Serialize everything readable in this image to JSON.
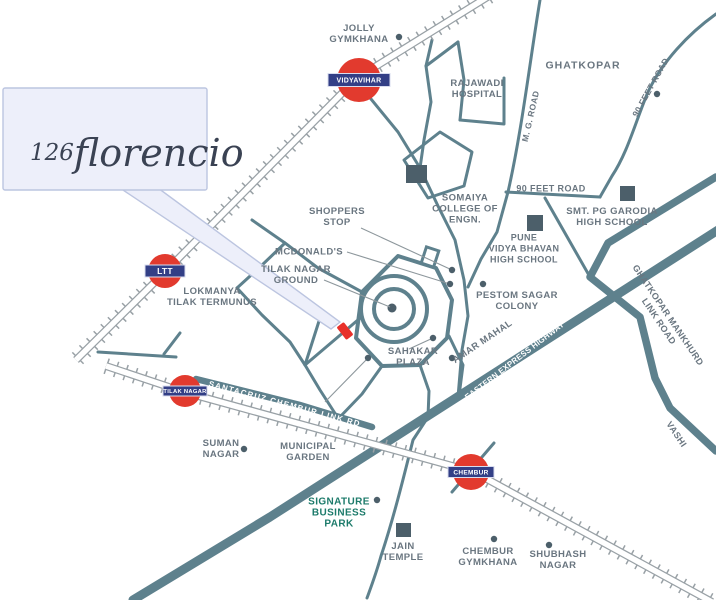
{
  "callout": {
    "prefix": "126",
    "name": "florencio"
  },
  "map": {
    "colors": {
      "road": "#5e818d",
      "rail": "#99a1a6",
      "label": "#6a7680",
      "green_label": "#1d7b6b",
      "white_label": "#ffffff",
      "badge_red": "#e23a2e",
      "badge_navy": "#333f86",
      "marker_red": "#e8302a",
      "building": "#4c5f6a",
      "callout_bg": "#edeffa"
    },
    "stations": [
      {
        "id": "vidyavihar",
        "label": "VIDYAVIHAR",
        "x": 359,
        "y": 80,
        "r": 22,
        "bw": 62,
        "bh": 13,
        "fs": 7
      },
      {
        "id": "ltt",
        "label": "LTT",
        "x": 165,
        "y": 271,
        "r": 17,
        "bw": 40,
        "bh": 12,
        "fs": 8.5
      },
      {
        "id": "tilak-nagar",
        "label": "TILAK NAGAR",
        "x": 185,
        "y": 391,
        "r": 16,
        "bw": 44,
        "bh": 10,
        "fs": 5.8
      },
      {
        "id": "chembur",
        "label": "CHEMBUR",
        "x": 471,
        "y": 472,
        "r": 18,
        "bw": 46,
        "bh": 11,
        "fs": 6.5
      }
    ],
    "labels": [
      {
        "id": "jolly-gymkhana",
        "x": 359,
        "y": 33,
        "lines": [
          "JOLLY",
          "GYMKHANA"
        ]
      },
      {
        "id": "ghatkopar",
        "x": 583,
        "y": 65,
        "size": 10.5,
        "ls": 1,
        "lines": [
          "GHATKOPAR"
        ]
      },
      {
        "id": "rajawadi-hospital",
        "x": 477,
        "y": 88,
        "lines": [
          "RAJAWADI",
          "HOSPITAL"
        ]
      },
      {
        "id": "somaiya-college",
        "x": 465,
        "y": 208,
        "lines": [
          "SOMAIYA",
          "COLLEGE OF",
          "ENGN."
        ]
      },
      {
        "id": "ninety-feet-road-h",
        "x": 551,
        "y": 188,
        "size": 9,
        "lines": [
          "90 FEET ROAD"
        ]
      },
      {
        "id": "garodia-school",
        "x": 612,
        "y": 216,
        "lines": [
          "SMT. PG GARODIA",
          "HIGH SCHOOL"
        ]
      },
      {
        "id": "pune-vidya-bhavan",
        "x": 524,
        "y": 248,
        "size": 9,
        "lines": [
          "PUNE",
          "VIDYA BHAVAN",
          "HIGH SCHOOL"
        ]
      },
      {
        "id": "shoppers-stop",
        "x": 337,
        "y": 216,
        "lines": [
          "SHOPPERS",
          "STOP"
        ]
      },
      {
        "id": "mcdonalds",
        "x": 309,
        "y": 251,
        "lines": [
          "MCDONALD'S"
        ]
      },
      {
        "id": "tilak-nagar-ground",
        "x": 296,
        "y": 274,
        "lines": [
          "TILAK NAGAR",
          "GROUND"
        ]
      },
      {
        "id": "lokmanya-terminus",
        "x": 212,
        "y": 296,
        "lines": [
          "LOKMANYA",
          "TILAK TERMUNUS"
        ]
      },
      {
        "id": "pestom-sagar",
        "x": 517,
        "y": 300,
        "lines": [
          "PESTOM SAGAR",
          "COLONY"
        ]
      },
      {
        "id": "sahakar-plaza",
        "x": 413,
        "y": 356,
        "lines": [
          "SAHAKAR",
          "PLAZA"
        ]
      },
      {
        "id": "suman-nagar",
        "x": 221,
        "y": 448,
        "lines": [
          "SUMAN",
          "NAGAR"
        ]
      },
      {
        "id": "municipal-garden",
        "x": 308,
        "y": 451,
        "lines": [
          "MUNICIPAL",
          "GARDEN"
        ]
      },
      {
        "id": "signature-park",
        "x": 339,
        "y": 512,
        "size": 10,
        "color": "#1d7b6b",
        "lines": [
          "SIGNATURE",
          "BUSINESS",
          "PARK"
        ]
      },
      {
        "id": "jain-temple",
        "x": 403,
        "y": 551,
        "lines": [
          "JAIN",
          "TEMPLE"
        ]
      },
      {
        "id": "chembur-gymkhana",
        "x": 488,
        "y": 556,
        "lines": [
          "CHEMBUR",
          "GYMKHANA"
        ]
      },
      {
        "id": "shubhash-nagar",
        "x": 558,
        "y": 559,
        "lines": [
          "SHUBHASH",
          "NAGAR"
        ]
      },
      {
        "id": "mg-road",
        "x": 530,
        "y": 116,
        "rotate": -77,
        "size": 8.5,
        "lines": [
          "M. G. ROAD"
        ]
      },
      {
        "id": "ninety-feet-road-d",
        "x": 650,
        "y": 87,
        "rotate": -61,
        "size": 8.5,
        "lines": [
          "90 FEET ROAD"
        ]
      },
      {
        "id": "gm-link-road",
        "x": 664,
        "y": 318,
        "rotate": 56,
        "size": 9,
        "lines": [
          "GHATKOPAR MANKHURD",
          "LINK ROAD"
        ]
      },
      {
        "id": "vashi",
        "x": 677,
        "y": 434,
        "rotate": 56,
        "size": 9,
        "lines": [
          "VASHI"
        ]
      },
      {
        "id": "amar-mahal",
        "x": 482,
        "y": 341,
        "rotate": -34,
        "size": 9.5,
        "lines": [
          "AMAR MAHAL"
        ]
      },
      {
        "id": "eastern-express-hwy",
        "x": 514,
        "y": 360,
        "rotate": -37.5,
        "size": 8,
        "color": "#ffffff",
        "ls": 0.2,
        "lines": [
          "EASTERN EXPRESS HIGHWAY"
        ]
      },
      {
        "id": "santacruz-link-rd",
        "x": 285,
        "y": 403,
        "rotate": 15,
        "size": 8,
        "color": "#ffffff",
        "ls": 1.2,
        "lines": [
          "SANTACRUZ CHEMBUR LINK RD"
        ]
      }
    ],
    "buildings": [
      {
        "id": "somaiya-square",
        "x": 406,
        "y": 165,
        "w": 21,
        "h": 18
      },
      {
        "id": "pune-vidya-square",
        "x": 527,
        "y": 215,
        "w": 16,
        "h": 16
      },
      {
        "id": "garodia-square",
        "x": 620,
        "y": 186,
        "w": 15,
        "h": 15
      },
      {
        "id": "jain-temple-square",
        "x": 396,
        "y": 523,
        "w": 15,
        "h": 14
      }
    ],
    "dots": [
      {
        "id": "jolly-gymkhana-dot",
        "x": 399,
        "y": 37
      },
      {
        "id": "ninety-feet-road-dot",
        "x": 657,
        "y": 94
      },
      {
        "id": "shoppers-stop-dot",
        "x": 452,
        "y": 270
      },
      {
        "id": "mcdonalds-dot",
        "x": 450,
        "y": 284
      },
      {
        "id": "pestom-sagar-dot",
        "x": 483,
        "y": 284
      },
      {
        "id": "amar-mahal-dot",
        "x": 452,
        "y": 358
      },
      {
        "id": "sahakar-plaza-dot",
        "x": 433,
        "y": 338
      },
      {
        "id": "ring-street-dot",
        "x": 368,
        "y": 358
      },
      {
        "id": "suman-nagar-dot",
        "x": 244,
        "y": 449
      },
      {
        "id": "signature-park-dot",
        "x": 377,
        "y": 500
      },
      {
        "id": "chembur-gymkhana-dot",
        "x": 494,
        "y": 539
      },
      {
        "id": "shubhash-nagar-dot",
        "x": 549,
        "y": 545
      }
    ],
    "leaders": [
      {
        "id": "shoppers-leader",
        "x1": 361,
        "y1": 228,
        "x2": 452,
        "y2": 270
      },
      {
        "id": "mcdonalds-leader",
        "x1": 347,
        "y1": 252,
        "x2": 450,
        "y2": 284
      },
      {
        "id": "ground-leader",
        "x1": 324,
        "y1": 280,
        "x2": 390,
        "y2": 307
      },
      {
        "id": "sahakar-leader",
        "x1": 433,
        "y1": 338,
        "x2": 409,
        "y2": 349
      },
      {
        "id": "ring-leader",
        "x1": 368,
        "y1": 358,
        "x2": 325,
        "y2": 402
      }
    ],
    "property_marker": {
      "id": "site-marker",
      "x": 345,
      "y": 331,
      "rotate": -38
    }
  }
}
